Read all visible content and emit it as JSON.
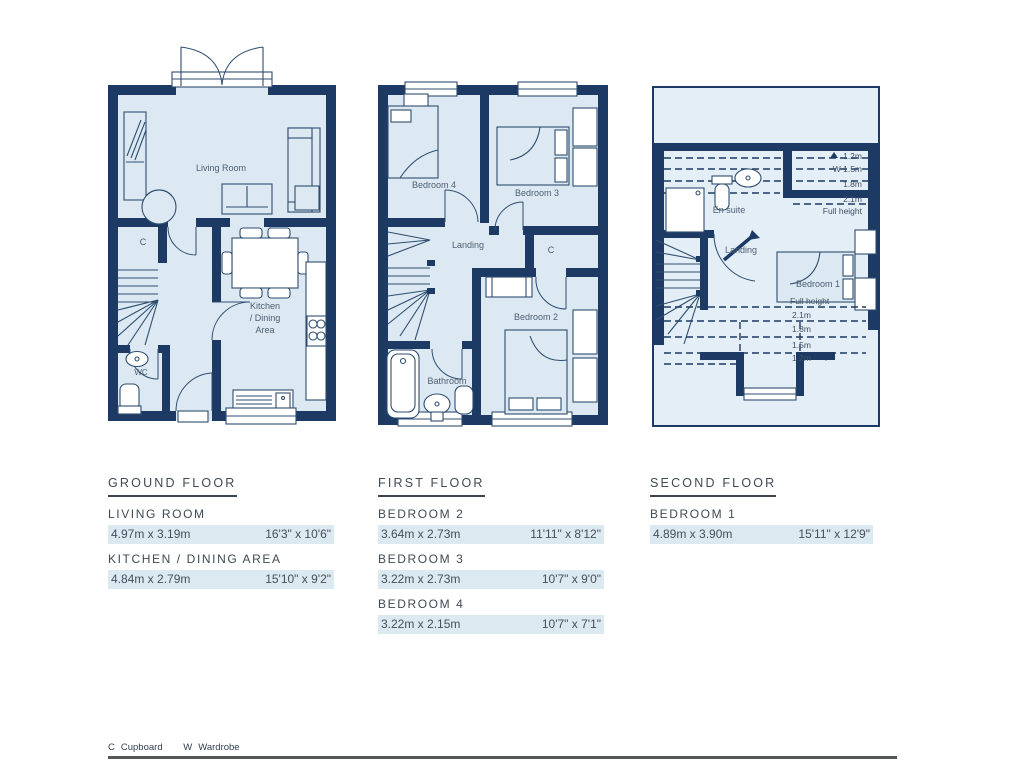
{
  "colors": {
    "wall": "#1c3a63",
    "room_fill": "#dce9f2",
    "eaves_fill": "#e4eef6",
    "table_text": "#3f4a54",
    "row_highlight": "#dbe9f1",
    "bottom_rule": "#55565a"
  },
  "plans": {
    "ground": {
      "living_room": "Living Room",
      "kitchen_line1": "Kitchen",
      "kitchen_line2": "/ Dining",
      "kitchen_line3": "Area",
      "cupboard": "C",
      "wc": "WC"
    },
    "first": {
      "bedroom4": "Bedroom 4",
      "bedroom3": "Bedroom 3",
      "landing": "Landing",
      "cupboard": "C",
      "bedroom2": "Bedroom 2",
      "bathroom": "Bathroom"
    },
    "second": {
      "ensuite": "En suite",
      "landing": "Landing",
      "bedroom1": "Bedroom 1",
      "top_labels": [
        "1.2m",
        "W 1.5m",
        "1.8m",
        "2.1m",
        "Full height"
      ],
      "bottom_labels": [
        "Full height",
        "2.1m",
        "1.8m",
        "1.5m",
        "1.2m"
      ]
    }
  },
  "tables": [
    {
      "title": "GROUND FLOOR",
      "rows": [
        {
          "name": "LIVING ROOM",
          "metric": "4.97m x 3.19m",
          "imperial": "16'3\" x 10'6\""
        },
        {
          "name": "KITCHEN / DINING AREA",
          "metric": "4.84m x 2.79m",
          "imperial": "15'10\" x 9'2\""
        }
      ]
    },
    {
      "title": "FIRST FLOOR",
      "rows": [
        {
          "name": "BEDROOM 2",
          "metric": "3.64m x 2.73m",
          "imperial": "11'11\" x 8'12\""
        },
        {
          "name": "BEDROOM 3",
          "metric": "3.22m x 2.73m",
          "imperial": "10'7\" x 9'0\""
        },
        {
          "name": "BEDROOM 4",
          "metric": "3.22m x 2.15m",
          "imperial": "10'7\" x 7'1\""
        }
      ]
    },
    {
      "title": "SECOND FLOOR",
      "rows": [
        {
          "name": "BEDROOM 1",
          "metric": "4.89m x 3.90m",
          "imperial": "15'11\" x 12'9\""
        }
      ]
    }
  ],
  "legend": [
    {
      "key": "C",
      "label": "Cupboard"
    },
    {
      "key": "W",
      "label": "Wardrobe"
    }
  ]
}
